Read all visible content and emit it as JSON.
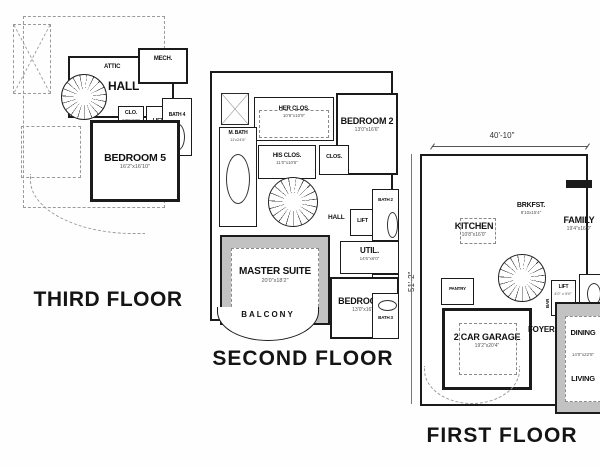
{
  "colors": {
    "wall": "#1b1b1b",
    "shade": "#c2c2c2",
    "dashed": "#9a9a9a",
    "background": "#fefefe"
  },
  "floors": [
    {
      "title": "THIRD FLOOR",
      "rooms": {
        "attic": {
          "name": "ATTIC"
        },
        "mech": {
          "name": "MECH."
        },
        "hall": {
          "name": "HALL"
        },
        "clo": {
          "name": "CLO.",
          "dims": "5'0\"x6'0\""
        },
        "lift": {
          "name": "LIFT"
        },
        "bath4": {
          "name": "BATH 4"
        },
        "bedroom5": {
          "name": "BEDROOM 5",
          "dims": "16'2\"x16'10\""
        }
      }
    },
    {
      "title": "SECOND FLOOR",
      "rooms": {
        "her_clos": {
          "name": "HER CLOS.",
          "dims": "10'6\"x10'9\""
        },
        "bedroom2": {
          "name": "BEDROOM 2",
          "dims": "13'0\"x16'6\""
        },
        "m_bath": {
          "name": "M. BATH",
          "dims": "11'x24'6\""
        },
        "his_clos": {
          "name": "HIS CLOS.",
          "dims": "11'0\"x10'6\""
        },
        "clos_a": {
          "name": "CLOS."
        },
        "hall": {
          "name": "HALL"
        },
        "lift": {
          "name": "LIFT"
        },
        "bath2": {
          "name": "BATH 2"
        },
        "util": {
          "name": "UTIL.",
          "dims": "14'6\"x6'0\""
        },
        "master_suite": {
          "name": "MASTER SUITE",
          "dims": "20'0\"x18'2\""
        },
        "clos_b": {
          "name": "CLOS."
        },
        "bedroom3": {
          "name": "BEDROOM 3",
          "dims": "13'0\"x16'6\""
        },
        "bath3": {
          "name": "BATH 3"
        },
        "balcony": {
          "name": "BALCONY"
        }
      }
    },
    {
      "title": "FIRST FLOOR",
      "overall_width": "40'-10\"",
      "overall_depth": "51'-2\"",
      "rooms": {
        "kitchen": {
          "name": "KITCHEN",
          "dims": "10'8\"x16'0\""
        },
        "brkfst": {
          "name": "BRKFST.",
          "dims": "8'10x15'4\""
        },
        "family": {
          "name": "FAMILY",
          "dims": "19'4\"x16'0\""
        },
        "pantry": {
          "name": "PANTRY"
        },
        "bar": {
          "name": "BAR"
        },
        "lift": {
          "name": "LIFT",
          "dims": "4'0\" x 5'0\""
        },
        "buffet": {
          "name": "BUFFET"
        },
        "garage": {
          "name": "2 CAR GARAGE",
          "dims": "19'2\"x20'4\""
        },
        "foyer": {
          "name": "FOYER"
        },
        "dining": {
          "name": "DINING",
          "dims": "14'0\"x22'8\""
        },
        "living": {
          "name": "LIVING"
        }
      }
    }
  ]
}
